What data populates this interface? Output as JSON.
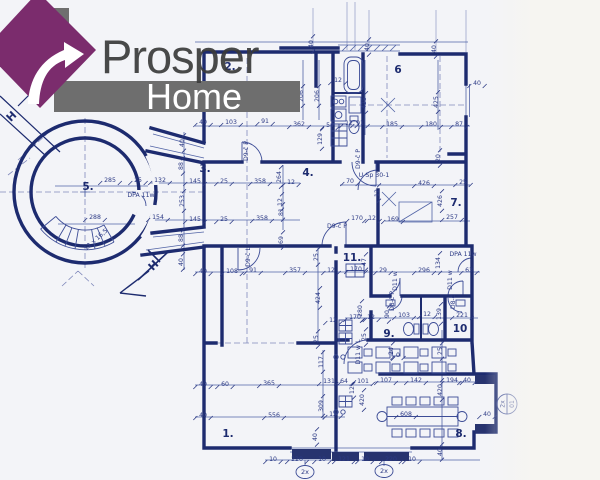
{
  "logo": {
    "brand": "Prosper",
    "sub": "Home",
    "house_purple": "#7b2c6d",
    "chimney_gray": "#6f6f6f",
    "banner_gray": "#6e6e6e",
    "brand_color": "#3a3a3a",
    "sub_color": "#ffffff"
  },
  "plan": {
    "paper": "#f3f4f8",
    "wall_ink": "#1d2b6f",
    "thin_ink": "#5264a6",
    "dim_ink": "#2c3a85",
    "dash_ink": "#8089bb",
    "rooms": [
      {
        "t": "1.",
        "x": 228,
        "y": 437
      },
      {
        "t": "2.",
        "x": 230,
        "y": 70
      },
      {
        "t": "3.",
        "x": 205,
        "y": 172
      },
      {
        "t": "4.",
        "x": 308,
        "y": 176
      },
      {
        "t": "5.",
        "x": 88,
        "y": 190
      },
      {
        "t": "6",
        "x": 398,
        "y": 73
      },
      {
        "t": "7.",
        "x": 456,
        "y": 206
      },
      {
        "t": "8.",
        "x": 461,
        "y": 437
      },
      {
        "t": "9.",
        "x": 389,
        "y": 337
      },
      {
        "t": "10",
        "x": 460,
        "y": 332
      },
      {
        "t": "11.",
        "x": 352,
        "y": 261
      }
    ],
    "dims": [
      {
        "t": "40",
        "x": 313,
        "y": 44,
        "r": -90
      },
      {
        "t": "40",
        "x": 369,
        "y": 47,
        "r": -90
      },
      {
        "t": "40",
        "x": 436,
        "y": 49,
        "r": -90
      },
      {
        "t": "12",
        "x": 338,
        "y": 82
      },
      {
        "t": "206",
        "x": 303,
        "y": 96,
        "r": -90
      },
      {
        "t": "206",
        "x": 319,
        "y": 96,
        "r": -90
      },
      {
        "t": "425",
        "x": 366,
        "y": 103,
        "r": -90
      },
      {
        "t": "425",
        "x": 438,
        "y": 102,
        "r": -90
      },
      {
        "t": "40",
        "x": 477,
        "y": 85
      },
      {
        "t": "40",
        "x": 203,
        "y": 124
      },
      {
        "t": "103",
        "x": 231,
        "y": 124
      },
      {
        "t": "91",
        "x": 265,
        "y": 123
      },
      {
        "t": "362",
        "x": 299,
        "y": 126
      },
      {
        "t": "54",
        "x": 330,
        "y": 127
      },
      {
        "t": "12",
        "x": 349,
        "y": 125
      },
      {
        "t": "91",
        "x": 360,
        "y": 125
      },
      {
        "t": "185",
        "x": 392,
        "y": 126
      },
      {
        "t": "180",
        "x": 431,
        "y": 126
      },
      {
        "t": "87",
        "x": 459,
        "y": 126
      },
      {
        "t": "129",
        "x": 322,
        "y": 139,
        "r": -90
      },
      {
        "t": "40",
        "x": 184,
        "y": 143,
        "r": -90
      },
      {
        "t": "88",
        "x": 183,
        "y": 166,
        "r": -90
      },
      {
        "t": "20",
        "x": 440,
        "y": 158,
        "r": -90
      },
      {
        "t": "285",
        "x": 110,
        "y": 182
      },
      {
        "t": "25",
        "x": 138,
        "y": 182
      },
      {
        "t": "132",
        "x": 160,
        "y": 182
      },
      {
        "t": "145",
        "x": 195,
        "y": 183
      },
      {
        "t": "25",
        "x": 224,
        "y": 183
      },
      {
        "t": "358",
        "x": 260,
        "y": 183
      },
      {
        "t": "264",
        "x": 281,
        "y": 177,
        "r": -90
      },
      {
        "t": "12",
        "x": 291,
        "y": 184
      },
      {
        "t": "70",
        "x": 350,
        "y": 183
      },
      {
        "t": "426",
        "x": 424,
        "y": 185
      },
      {
        "t": "25",
        "x": 463,
        "y": 184
      },
      {
        "t": "253",
        "x": 184,
        "y": 201,
        "r": -90
      },
      {
        "t": "12",
        "x": 379,
        "y": 193,
        "r": -90
      },
      {
        "t": "426",
        "x": 442,
        "y": 201,
        "r": -90
      },
      {
        "t": "288",
        "x": 95,
        "y": 219
      },
      {
        "t": "154",
        "x": 158,
        "y": 219
      },
      {
        "t": "145",
        "x": 195,
        "y": 221
      },
      {
        "t": "25",
        "x": 224,
        "y": 221
      },
      {
        "t": "358",
        "x": 262,
        "y": 220
      },
      {
        "t": "12",
        "x": 282,
        "y": 202,
        "r": -90
      },
      {
        "t": "81",
        "x": 283,
        "y": 212,
        "r": -90
      },
      {
        "t": "170",
        "x": 357,
        "y": 220
      },
      {
        "t": "12",
        "x": 372,
        "y": 220
      },
      {
        "t": "169",
        "x": 393,
        "y": 221
      },
      {
        "t": "257",
        "x": 452,
        "y": 219
      },
      {
        "t": "88",
        "x": 183,
        "y": 238,
        "r": -90
      },
      {
        "t": "40",
        "x": 183,
        "y": 262,
        "r": -90
      },
      {
        "t": "40",
        "x": 203,
        "y": 273
      },
      {
        "t": "108",
        "x": 232,
        "y": 273
      },
      {
        "t": "91",
        "x": 253,
        "y": 272
      },
      {
        "t": "357",
        "x": 295,
        "y": 272
      },
      {
        "t": "12",
        "x": 331,
        "y": 272
      },
      {
        "t": "69",
        "x": 283,
        "y": 240,
        "r": -90
      },
      {
        "t": "47",
        "x": 366,
        "y": 262,
        "r": -90
      },
      {
        "t": "170",
        "x": 356,
        "y": 271
      },
      {
        "t": "29",
        "x": 383,
        "y": 272
      },
      {
        "t": "296",
        "x": 424,
        "y": 272
      },
      {
        "t": "134",
        "x": 440,
        "y": 263,
        "r": -90
      },
      {
        "t": "63",
        "x": 469,
        "y": 272
      },
      {
        "t": "25",
        "x": 318,
        "y": 257,
        "r": -90
      },
      {
        "t": "424",
        "x": 320,
        "y": 298,
        "r": -90
      },
      {
        "t": "25",
        "x": 318,
        "y": 339,
        "r": -90
      },
      {
        "t": "12",
        "x": 333,
        "y": 322
      },
      {
        "t": "170",
        "x": 355,
        "y": 319
      },
      {
        "t": "12",
        "x": 371,
        "y": 319
      },
      {
        "t": "90",
        "x": 389,
        "y": 314,
        "r": -90
      },
      {
        "t": "103",
        "x": 404,
        "y": 317
      },
      {
        "t": "12",
        "x": 427,
        "y": 316
      },
      {
        "t": "221",
        "x": 462,
        "y": 317
      },
      {
        "t": "280",
        "x": 362,
        "y": 311,
        "r": -90
      },
      {
        "t": "139",
        "x": 441,
        "y": 314,
        "r": -90
      },
      {
        "t": "25",
        "x": 366,
        "y": 337,
        "r": -90
      },
      {
        "t": "24",
        "x": 393,
        "y": 351,
        "r": -90
      },
      {
        "t": "0",
        "x": 398,
        "y": 357
      },
      {
        "t": "25",
        "x": 442,
        "y": 351,
        "r": -90
      },
      {
        "t": "117",
        "x": 323,
        "y": 362,
        "r": -90
      },
      {
        "t": "40",
        "x": 203,
        "y": 386
      },
      {
        "t": "60",
        "x": 225,
        "y": 386
      },
      {
        "t": "365",
        "x": 269,
        "y": 385
      },
      {
        "t": "131",
        "x": 329,
        "y": 383
      },
      {
        "t": "64",
        "x": 344,
        "y": 383
      },
      {
        "t": "101",
        "x": 363,
        "y": 383
      },
      {
        "t": "12",
        "x": 354,
        "y": 390,
        "r": -90
      },
      {
        "t": "420",
        "x": 364,
        "y": 400,
        "r": -90
      },
      {
        "t": "107",
        "x": 386,
        "y": 382
      },
      {
        "t": "142",
        "x": 416,
        "y": 382
      },
      {
        "t": "194",
        "x": 452,
        "y": 382
      },
      {
        "t": "40",
        "x": 467,
        "y": 382
      },
      {
        "t": "420",
        "x": 442,
        "y": 390,
        "r": -90
      },
      {
        "t": "309",
        "x": 323,
        "y": 406,
        "r": -90
      },
      {
        "t": "556",
        "x": 274,
        "y": 417
      },
      {
        "t": "12",
        "x": 333,
        "y": 416
      },
      {
        "t": "40",
        "x": 203,
        "y": 417
      },
      {
        "t": "608",
        "x": 406,
        "y": 416
      },
      {
        "t": "40",
        "x": 487,
        "y": 416
      },
      {
        "t": "40",
        "x": 317,
        "y": 437,
        "r": -90
      },
      {
        "t": "40",
        "x": 442,
        "y": 452,
        "r": -90
      },
      {
        "t": "10",
        "x": 273,
        "y": 461
      },
      {
        "t": "220",
        "x": 297,
        "y": 461
      },
      {
        "t": "10",
        "x": 322,
        "y": 461
      },
      {
        "t": "121",
        "x": 344,
        "y": 461
      },
      {
        "t": "10",
        "x": 365,
        "y": 461
      },
      {
        "t": "220",
        "x": 391,
        "y": 461
      },
      {
        "t": "10",
        "x": 412,
        "y": 461
      }
    ],
    "notes": [
      {
        "t": "DPA 11w",
        "x": 141,
        "y": 197
      },
      {
        "t": "DPA 11w",
        "x": 463,
        "y": 256
      },
      {
        "t": "U-Sp 30-1",
        "x": 374,
        "y": 177
      },
      {
        "t": "12 x 16,5",
        "x": 97,
        "y": 241,
        "r": -42
      },
      {
        "t": "D9-č P",
        "x": 248,
        "y": 151,
        "r": -90
      },
      {
        "t": "D9-č P",
        "x": 360,
        "y": 159,
        "r": -90
      },
      {
        "t": "D9-č L",
        "x": 250,
        "y": 257,
        "r": -90
      },
      {
        "t": "D9-č P",
        "x": 337,
        "y": 228
      },
      {
        "t": "D8-č P",
        "x": 394,
        "y": 301,
        "r": -90
      },
      {
        "t": "D8-č",
        "x": 455,
        "y": 302,
        "r": -90
      },
      {
        "t": "D11 w",
        "x": 397,
        "y": 281,
        "r": -90
      },
      {
        "t": "D11 w",
        "x": 452,
        "y": 280,
        "r": -90
      },
      {
        "t": "D11 w L",
        "x": 360,
        "y": 352,
        "r": -90
      }
    ],
    "markers": [
      {
        "t": "H",
        "x": 14,
        "y": 119,
        "r": -45
      },
      {
        "t": "H",
        "x": 156,
        "y": 268,
        "r": -45
      }
    ],
    "window_counts": [
      {
        "t": "2x",
        "x": 305,
        "y": 474
      },
      {
        "t": "2x",
        "x": 384,
        "y": 473
      }
    ],
    "detail_badge": {
      "top": "2x",
      "bottom": "01",
      "x": 507,
      "y": 404
    }
  }
}
